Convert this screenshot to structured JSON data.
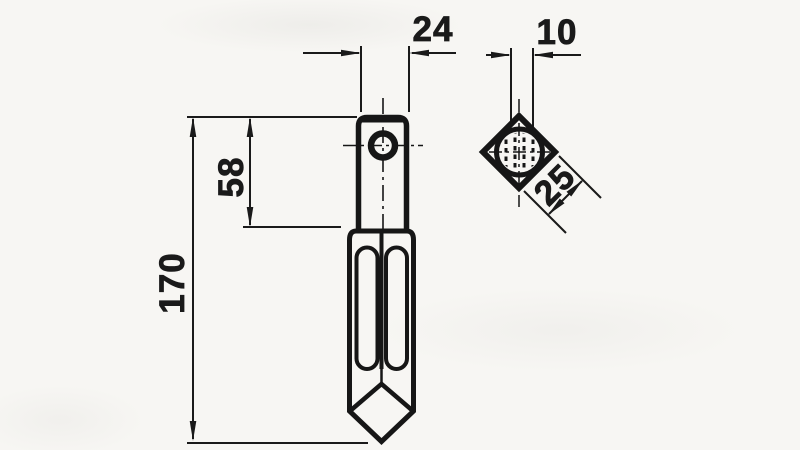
{
  "drawing": {
    "type": "technical-dimension-drawing",
    "views": {
      "front_view": "pointed tine with top mounting hole and two vertical slots",
      "section_view": "rotated square cross-section with hatched circular hole"
    },
    "dimensions": {
      "shaft_width": "24",
      "hole_width": "10",
      "upper_section_length": "58",
      "total_length": "170",
      "section_side": "25"
    },
    "colors": {
      "ink": "#161616",
      "paper": "#f7f6f3"
    }
  }
}
